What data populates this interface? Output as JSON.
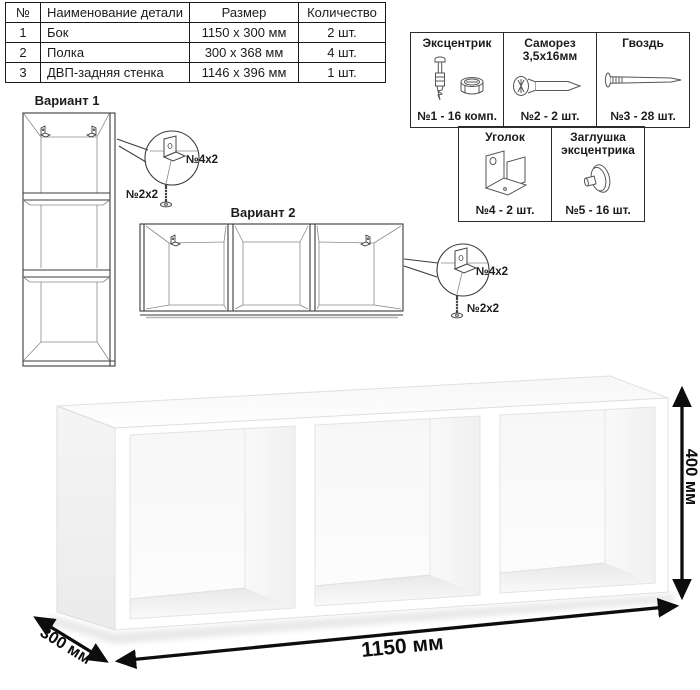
{
  "parts_table": {
    "headers": [
      "№",
      "Наименование детали",
      "Размер",
      "Количество"
    ],
    "rows": [
      {
        "num": "1",
        "name": "Бок",
        "size": "1150 х 300 мм",
        "qty": "2 шт."
      },
      {
        "num": "2",
        "name": "Полка",
        "size": "300 х 368 мм",
        "qty": "4 шт."
      },
      {
        "num": "3",
        "name": "ДВП-задняя стенка",
        "size": "1146 х 396 мм",
        "qty": "1 шт."
      }
    ]
  },
  "hardware": {
    "items": [
      {
        "title": "Эксцентрик",
        "count": "№1 - 16 комп.",
        "icon": "cam-bolt-icon"
      },
      {
        "title": "Саморез",
        "title2": "3,5х16мм",
        "count": "№2 - 2 шт.",
        "icon": "screw-icon"
      },
      {
        "title": "Гвоздь",
        "count": "№3 - 28 шт.",
        "icon": "nail-icon"
      },
      {
        "title": "Уголок",
        "count": "№4 - 2 шт.",
        "icon": "corner-bracket-icon"
      },
      {
        "title": "Заглушка",
        "title2": "эксцентрика",
        "count": "№5 - 16 шт.",
        "icon": "cam-cover-icon"
      }
    ]
  },
  "variants": {
    "variant1": {
      "title": "Вариант 1",
      "callout": {
        "bracket_label": "№4х2",
        "screw_label": "№2х2"
      }
    },
    "variant2": {
      "title": "Вариант 2",
      "callout": {
        "bracket_label": "№4х2",
        "screw_label": "№2х2"
      }
    }
  },
  "dimensions": {
    "width": "1150 мм",
    "height": "400 мм",
    "depth": "300 мм"
  },
  "colors": {
    "line": "#3b3b3b",
    "dimension": "#0d0d0d",
    "shading": "#f2f2f2"
  }
}
